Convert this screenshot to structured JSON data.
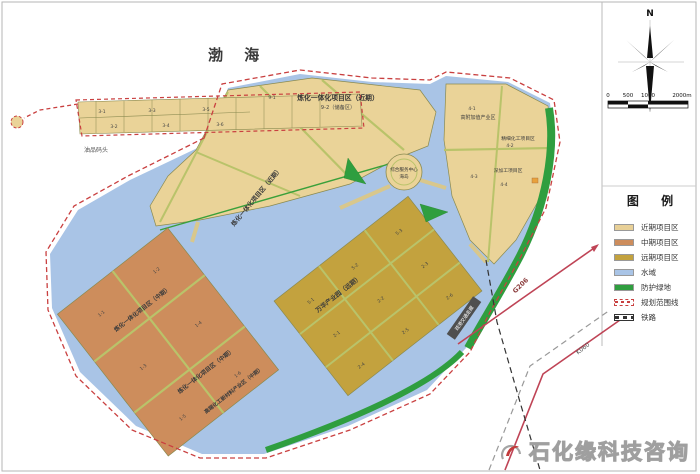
{
  "map": {
    "sea_label": "渤  海",
    "harbor_label": "油品码头",
    "zones": {
      "refinery_near_title": "炼化一体化项目区（近期）",
      "refinery_near_sub": "9-2（储备区）",
      "refinery_near_diag": "炼化一体化项目区（近期）",
      "refinery_mid_1": "炼化一体化项目区（中期）",
      "refinery_mid_2": "炼化一体化项目区（中期）",
      "highend_mid": "高端化工新材料产业区（中期）",
      "wanhua_far": "万华产业园（远期）",
      "highvalue": "高附加值产业区",
      "fine_chem": "精细化工项目区",
      "deep_process": "深加工项目区",
      "service_center": "综合服务中心",
      "service_center_sub": "海岛",
      "corridor": "疏港交通走廊"
    },
    "roads": {
      "g206": "G206",
      "k060": "K060"
    },
    "codes": {
      "c31": "3-1",
      "c32": "3-2",
      "c33": "3-3",
      "c34": "3-4",
      "c35": "3-5",
      "c36": "3-6",
      "c91": "9-1",
      "c41": "4-1",
      "c42": "4-2",
      "c43": "4-3",
      "c44": "4-4",
      "c11": "1-1",
      "c12": "1-2",
      "c13": "1-3",
      "c14": "1-4",
      "c15": "1-5",
      "c16": "1-6",
      "c51": "5-1",
      "c52": "5-2",
      "c53": "5-3",
      "c21": "2-1",
      "c22": "2-2",
      "c23": "2-3",
      "c24": "2-4",
      "c25": "2-5",
      "c26": "2-6"
    }
  },
  "compass": {
    "north_label": "N"
  },
  "scalebar": {
    "ticks": [
      "0",
      "500",
      "1000",
      "2000m"
    ]
  },
  "legend": {
    "title": "图  例",
    "items": [
      {
        "label": "近期项目区",
        "type": "fill",
        "color": "#e8d097"
      },
      {
        "label": "中期项目区",
        "type": "fill",
        "color": "#cd8d5c"
      },
      {
        "label": "远期项目区",
        "type": "fill",
        "color": "#c3a23e"
      },
      {
        "label": "水域",
        "type": "fill",
        "color": "#a9c4e6"
      },
      {
        "label": "防护绿地",
        "type": "fill",
        "color": "#2f9e3f"
      },
      {
        "label": "规划范围线",
        "type": "line-red",
        "color": "#c94040"
      },
      {
        "label": "铁路",
        "type": "rail",
        "color": "#333333"
      }
    ]
  },
  "watermark": {
    "text": "石化缘科技咨询"
  }
}
